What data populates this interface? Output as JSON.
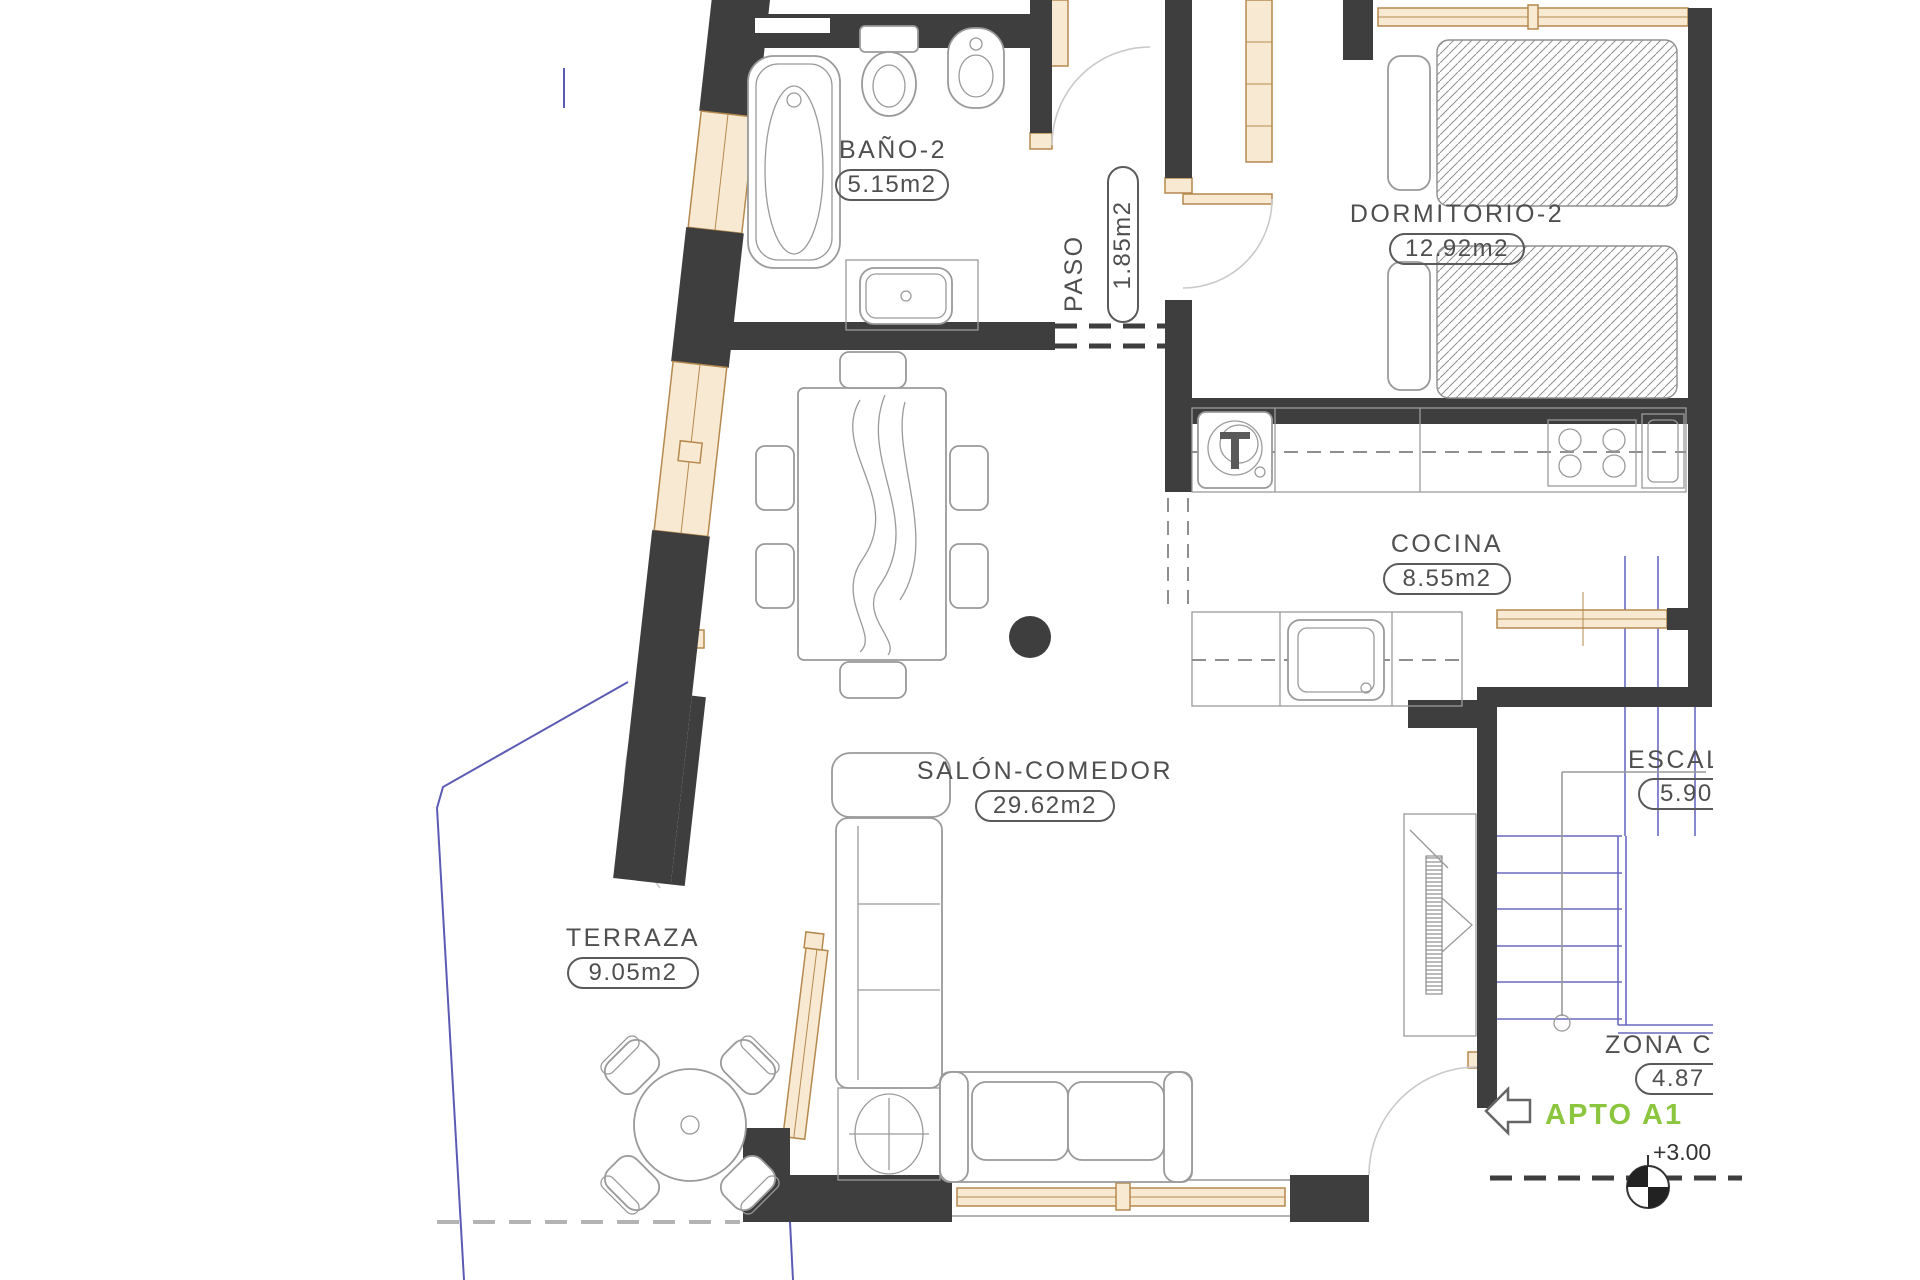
{
  "plan": {
    "rooms": [
      {
        "id": "bano2",
        "name": "BAÑO-2",
        "area": "5.15m2"
      },
      {
        "id": "paso",
        "name": "PASO",
        "area": "1.85m2"
      },
      {
        "id": "dormitorio2",
        "name": "DORMITORIO-2",
        "area": "12.92m2"
      },
      {
        "id": "cocina",
        "name": "COCINA",
        "area": "8.55m2"
      },
      {
        "id": "salon",
        "name": "SALÓN-COMEDOR",
        "area": "29.62m2"
      },
      {
        "id": "terraza",
        "name": "TERRAZA",
        "area": "9.05m2"
      },
      {
        "id": "escalera",
        "name": "ESCAL",
        "area": "5.90"
      },
      {
        "id": "zona_comun",
        "name": "ZONA C",
        "area": "4.87"
      }
    ],
    "annotations": {
      "apartment_label": "APTO A1",
      "level_mark": "+3.00"
    },
    "colors": {
      "wall": "#3e3e3e",
      "wood_stroke": "#b5894e",
      "wood_fill": "#f8ead2",
      "stairs_blue": "#6a6ac1",
      "boundary_blue": "#5b5bb4",
      "furniture_gray": "#9a9a9a",
      "label_text": "#4f4f4f",
      "accent_green": "#8CC63E",
      "level_text": "#333333"
    }
  }
}
